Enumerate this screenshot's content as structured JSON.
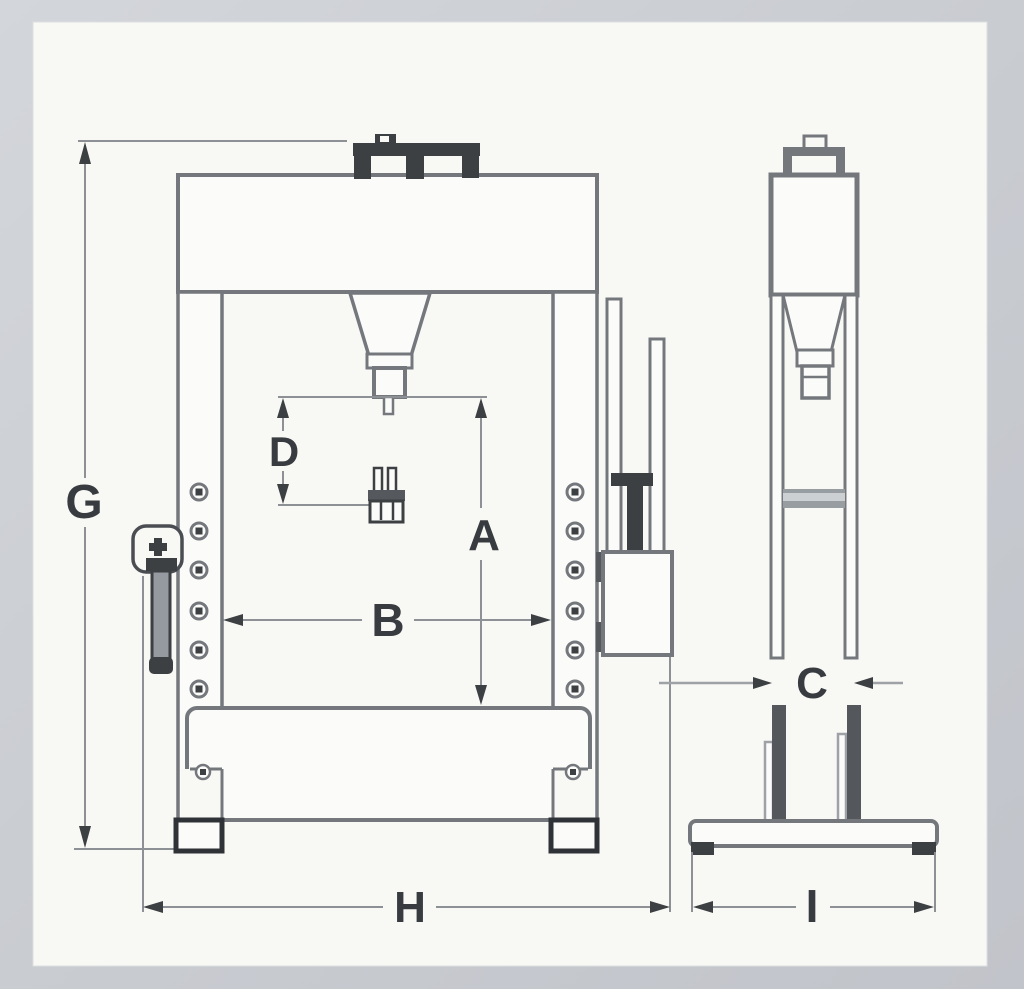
{
  "diagram": {
    "subject": "Hydraulic shop press dimensional line drawing, front elevation and side elevation",
    "views": {
      "front": "front-view",
      "side": "side-view"
    }
  },
  "labels": {
    "G": "G",
    "D": "D",
    "A": "A",
    "B": "B",
    "H": "H",
    "C": "C",
    "I": "I"
  },
  "colors": {
    "frame_background": "#c9ccd1",
    "paper": "#f8f8f5",
    "outline": "#74787d",
    "dark_detail": "#3c4043",
    "dimension_line": "#8d9195",
    "label_text": "#383c40"
  }
}
